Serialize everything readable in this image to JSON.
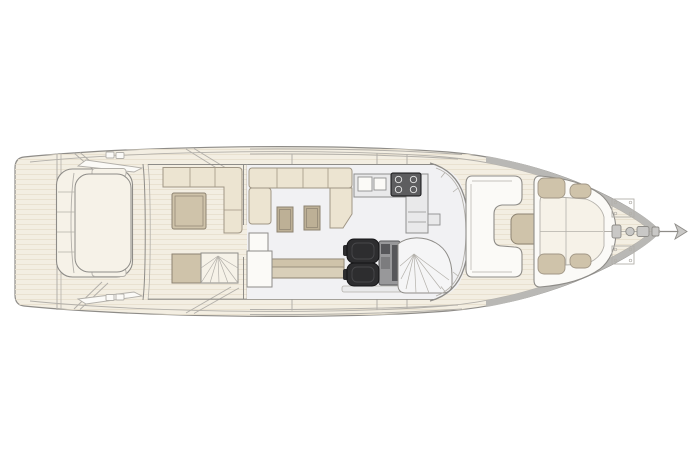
{
  "canvas": {
    "width": 699,
    "height": 466,
    "background": "#ffffff"
  },
  "colors": {
    "outline": "#8e8c88",
    "outline_soft": "#b3b0aa",
    "deck": "#f3eee2",
    "deck_stripe": "#e8e0ce",
    "gunwale": "#b9b8b5",
    "floor": "#f1f1f3",
    "white": "#fbfaf7",
    "cushion": "#f6f2e8",
    "sofa": "#ece4d1",
    "sofa_edge": "#a09685",
    "table": "#bdb096",
    "table_edge": "#8d8371",
    "cabinet_tan": "#cfc3aa",
    "sideboard_light": "#d9cfb9",
    "counter": "#e9e9ea",
    "counter_edge": "#8f8f8f",
    "appliance": "#5d5d5f",
    "burner": "#e8e8e8",
    "seat": "#2d2d2f",
    "seat_inner": "#47474a",
    "seat_edge": "#141416",
    "console": "#98989a",
    "console_mid": "#7c7c7e",
    "console_dark": "#57575a",
    "stair": "#f5f5f6",
    "metal": "#c9c8c6"
  },
  "plan": {
    "type": "motor-yacht-main-deck-plan",
    "orientation": "bow-right",
    "areas": [
      "swim-platform",
      "stern-sunpad",
      "aft-cockpit",
      "cockpit-sofa",
      "cockpit-table",
      "flybridge-stairs",
      "salon",
      "salon-sofa",
      "coffee-tables",
      "sideboard",
      "galley",
      "sink",
      "cooktop",
      "helm-station",
      "helm-seats",
      "lower-deck-staircase",
      "windshield",
      "bow-lounge",
      "bow-table",
      "bow-sunpad",
      "foredeck",
      "windlass",
      "anchor"
    ]
  }
}
